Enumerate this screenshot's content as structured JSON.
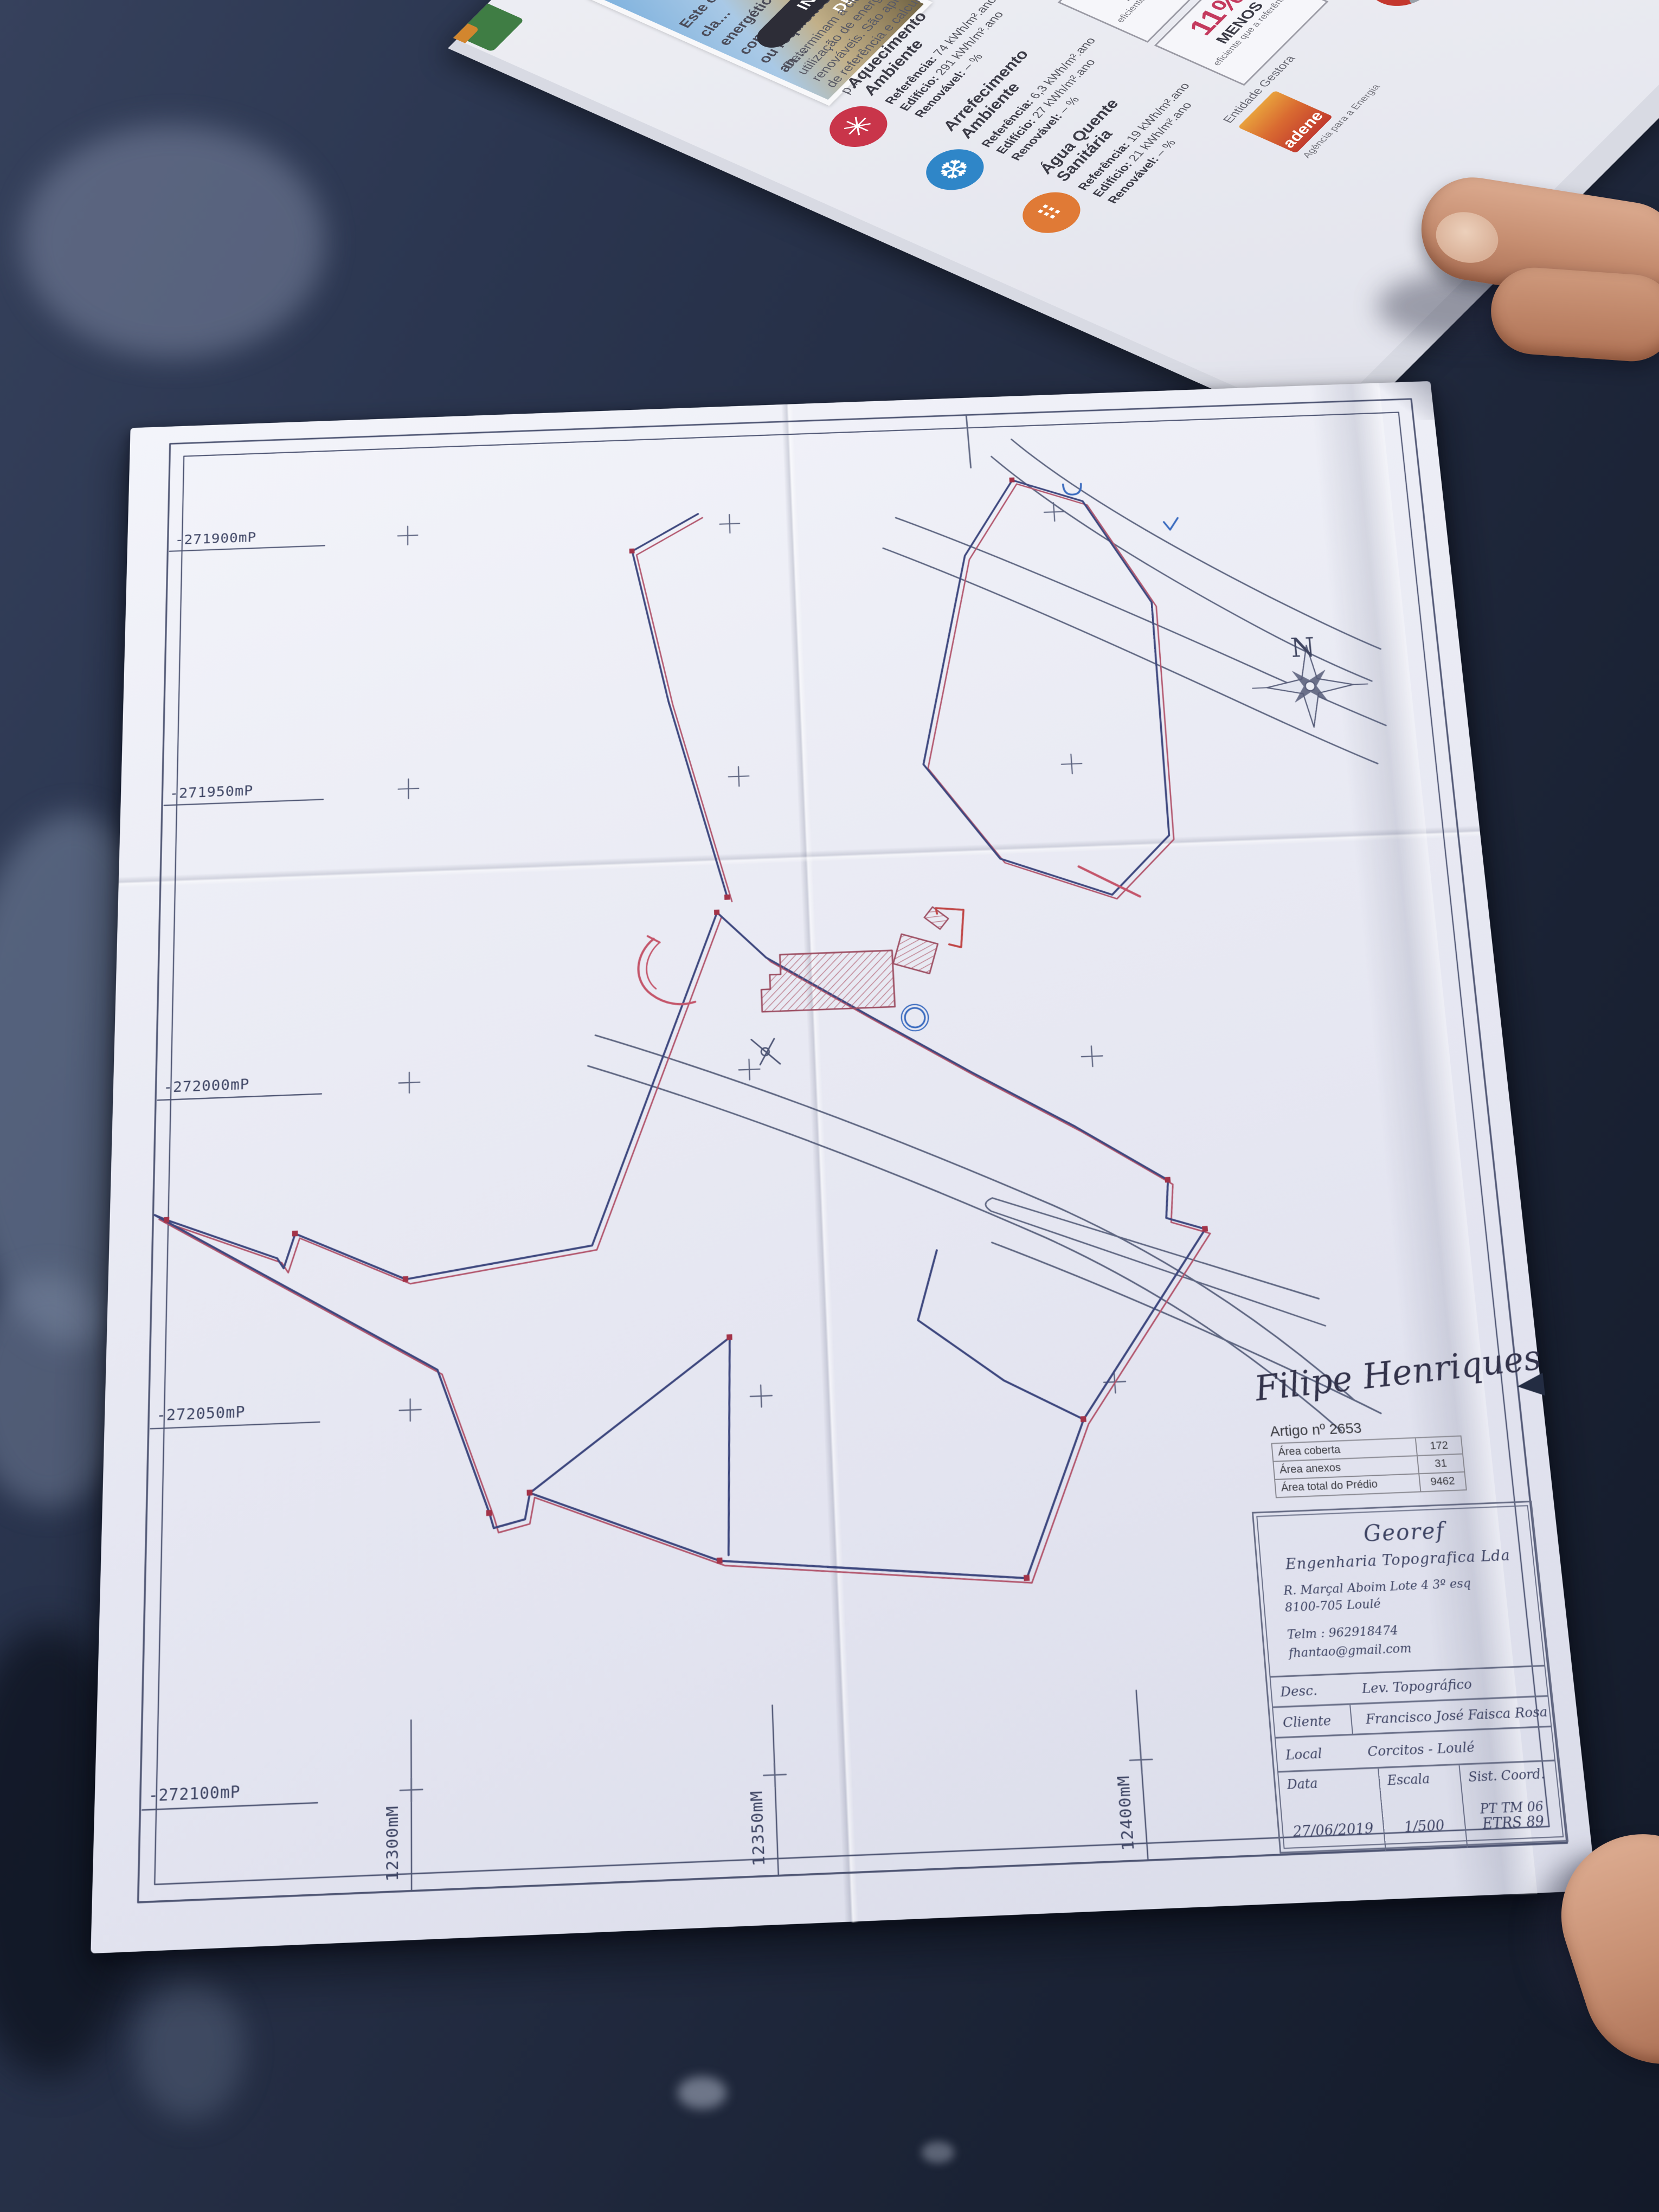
{
  "map_sheet": {
    "left_coordinate_labels": [
      "-271900mP",
      "-271950mP",
      "-272000mP",
      "-272050mP",
      "-272100mP"
    ],
    "bottom_coordinate_labels": [
      "12300mM",
      "12350mM",
      "12400mM"
    ],
    "north_label": "N",
    "signature_text": "Filipe Henriques",
    "artigo_table": {
      "title": "Artigo nº 2653",
      "rows": [
        {
          "label": "Área coberta",
          "value": "172"
        },
        {
          "label": "Área anexos",
          "value": "31"
        },
        {
          "label": "Área total do Prédio",
          "value": "9462"
        }
      ]
    },
    "title_block": {
      "company": "Georef",
      "subtitle": "Engenharia Topografica Lda",
      "address_line1": "R. Marçal Aboim Lote 4 3º esq",
      "address_line2": "8100-705 Loulé",
      "phone": "Telm : 962918474",
      "email": "fhantao@gmail.com",
      "desc_label": "Desc.",
      "desc_value": "Lev. Topográfico",
      "client_label": "Cliente",
      "client_value": "Francisco José Faisca Rosa",
      "local_label": "Local",
      "local_value": "Corcitos - Loulé",
      "date_label": "Data",
      "date_value": "27/06/2019",
      "scale_label": "Escala",
      "scale_value": "1/500",
      "coord_label": "Sist. Coord.",
      "coord_value_line1": "PT TM 06",
      "coord_value_line2": "ETRS 89"
    }
  },
  "brochure": {
    "intro_lines": [
      "Este certificado apresenta a cla…",
      "energético deste edifício nas con…",
      "ou requisitos aplicáveis para o an…"
    ],
    "pill_label": "INDICADORES DE DESEMPENHO",
    "body_lines": [
      "Determinam a classe energética do edi…",
      "utilização de energia, incluindo o con…",
      "renováveis. São apresentados comparati…",
      "de referência e calculados em condições p…"
    ],
    "sections": [
      {
        "title_line1": "Aquecimento",
        "title_line2": "Ambiente",
        "ref_label": "Referência:",
        "ref_value": "74 kWh/m².ano",
        "ed_label": "Edifício:",
        "ed_value": "291 kWh/m².ano",
        "ren_label": "Renovável:",
        "ren_value": "– %",
        "badge_percent": "250%",
        "badge_word": "MENOS",
        "badge_small": "eficiente que a referência"
      },
      {
        "title_line1": "Arrefecimento",
        "title_line2": "Ambiente",
        "ref_label": "Referência:",
        "ref_value": "6,3 kWh/m².ano",
        "ed_label": "Edifício:",
        "ed_value": "27 kWh/m².ano",
        "ren_label": "Renovável:",
        "ren_value": "– %",
        "badge_percent": "250%",
        "badge_word": "MENOS",
        "badge_small": "eficiente que a referência"
      },
      {
        "title_line1": "Água Quente",
        "title_line2": "Sanitária",
        "ref_label": "Referência:",
        "ref_value": "19 kWh/m².ano",
        "ed_label": "Edifício:",
        "ed_value": "21 kWh/m².ano",
        "ren_label": "Renovável:",
        "ren_value": "– %",
        "badge_percent": "11%",
        "badge_word": "MENOS",
        "badge_small": "eficiente que a referência"
      }
    ],
    "gestora_label": "Entidade Gestora",
    "adene_name": "adene",
    "adene_sub": "Agência para a Energia",
    "fiscal_label": "Entidade Fiscalizadora",
    "dgeg_line1": "Direção Geral",
    "dgeg_line2": "de Energia e Geologia",
    "partial_letter": "L"
  },
  "colors": {
    "table_dark": "#1a2234",
    "paper": "#eaebf4",
    "ink_blue": "#3d4463",
    "boundary_navy": "#3d477e",
    "offset_red": "#b2556c",
    "hatch_red": "#b06070",
    "road_gray": "#5d6580",
    "circle_blue": "#3a6bbf",
    "badge_pink": "#c43a5e"
  }
}
